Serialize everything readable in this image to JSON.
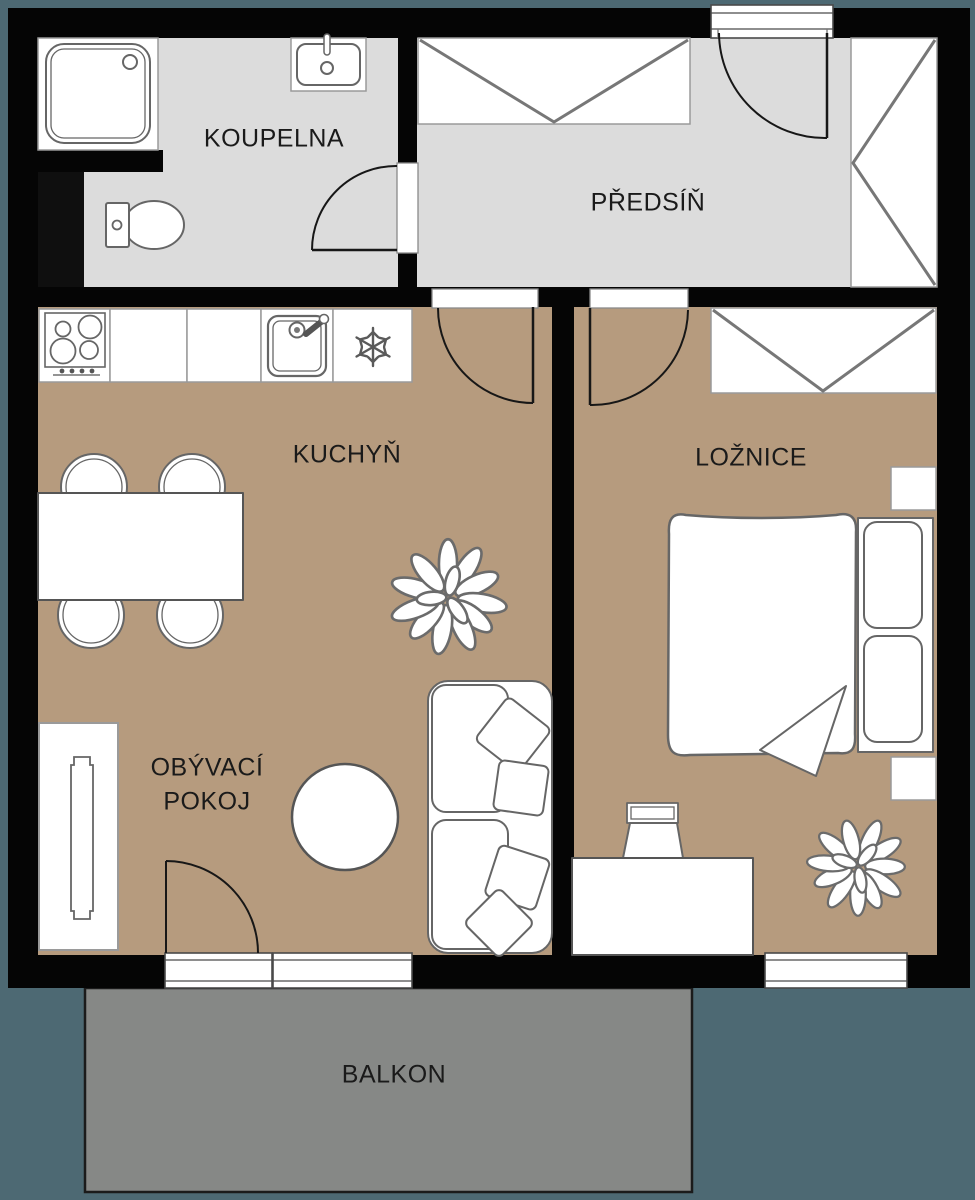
{
  "title": "Apartment floor plan",
  "rooms": {
    "bathroom": {
      "label": "KOUPELNA"
    },
    "hall": {
      "label": "PŘEDSÍŇ"
    },
    "kitchen": {
      "label": "KUCHYŇ"
    },
    "bedroom": {
      "label": "LOŽNICE"
    },
    "living_room": {
      "label_line1": "OBÝVACÍ",
      "label_line2": "POKOJ"
    },
    "balcony": {
      "label": "BALKON"
    }
  },
  "colors": {
    "background": "#4d6973",
    "wall": "#050505",
    "room_gray": "#dcdcdc",
    "room_tan": "#b69b7e",
    "balcony_gray": "#868886",
    "furniture_outline": "#666666"
  },
  "furniture_icons": [
    "shower-icon",
    "washbasin-icon",
    "toilet-icon",
    "wardrobe-icon",
    "entrance-door-icon",
    "stove-icon",
    "kitchen-sink-icon",
    "freezer-icon",
    "dining-table-icon",
    "chair-icon",
    "plant-icon",
    "tv-stand-icon",
    "coffee-table-icon",
    "sofa-icon",
    "pillow-icon",
    "bed-icon",
    "nightstand-icon",
    "desk-icon",
    "desk-chair-icon",
    "window-icon",
    "balcony-door-icon",
    "door-swing-icon"
  ]
}
